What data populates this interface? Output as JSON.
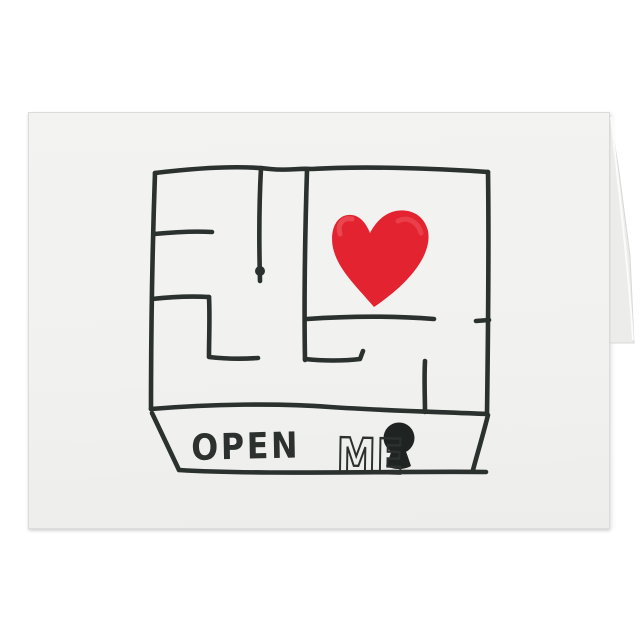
{
  "product": {
    "background_color": "#ffffff"
  },
  "card": {
    "surface_color": "#f1f1ef",
    "edge_color": "#dcdcda",
    "fold_color": "#ececea",
    "front_text": "OPEN ME",
    "words": {
      "open": "OPEN",
      "me": "ME"
    }
  },
  "illustration": {
    "type": "hand-drawn square maze with painted heart at center-right, banner below reading OPEN ME with black keyhole",
    "ink_color": "#2b312f",
    "keyhole_color": "#1f2321",
    "heart_color": "#e32430",
    "heart_highlight": "#f2606a",
    "icons": {
      "heart": "heart-icon",
      "keyhole": "keyhole-icon"
    }
  }
}
